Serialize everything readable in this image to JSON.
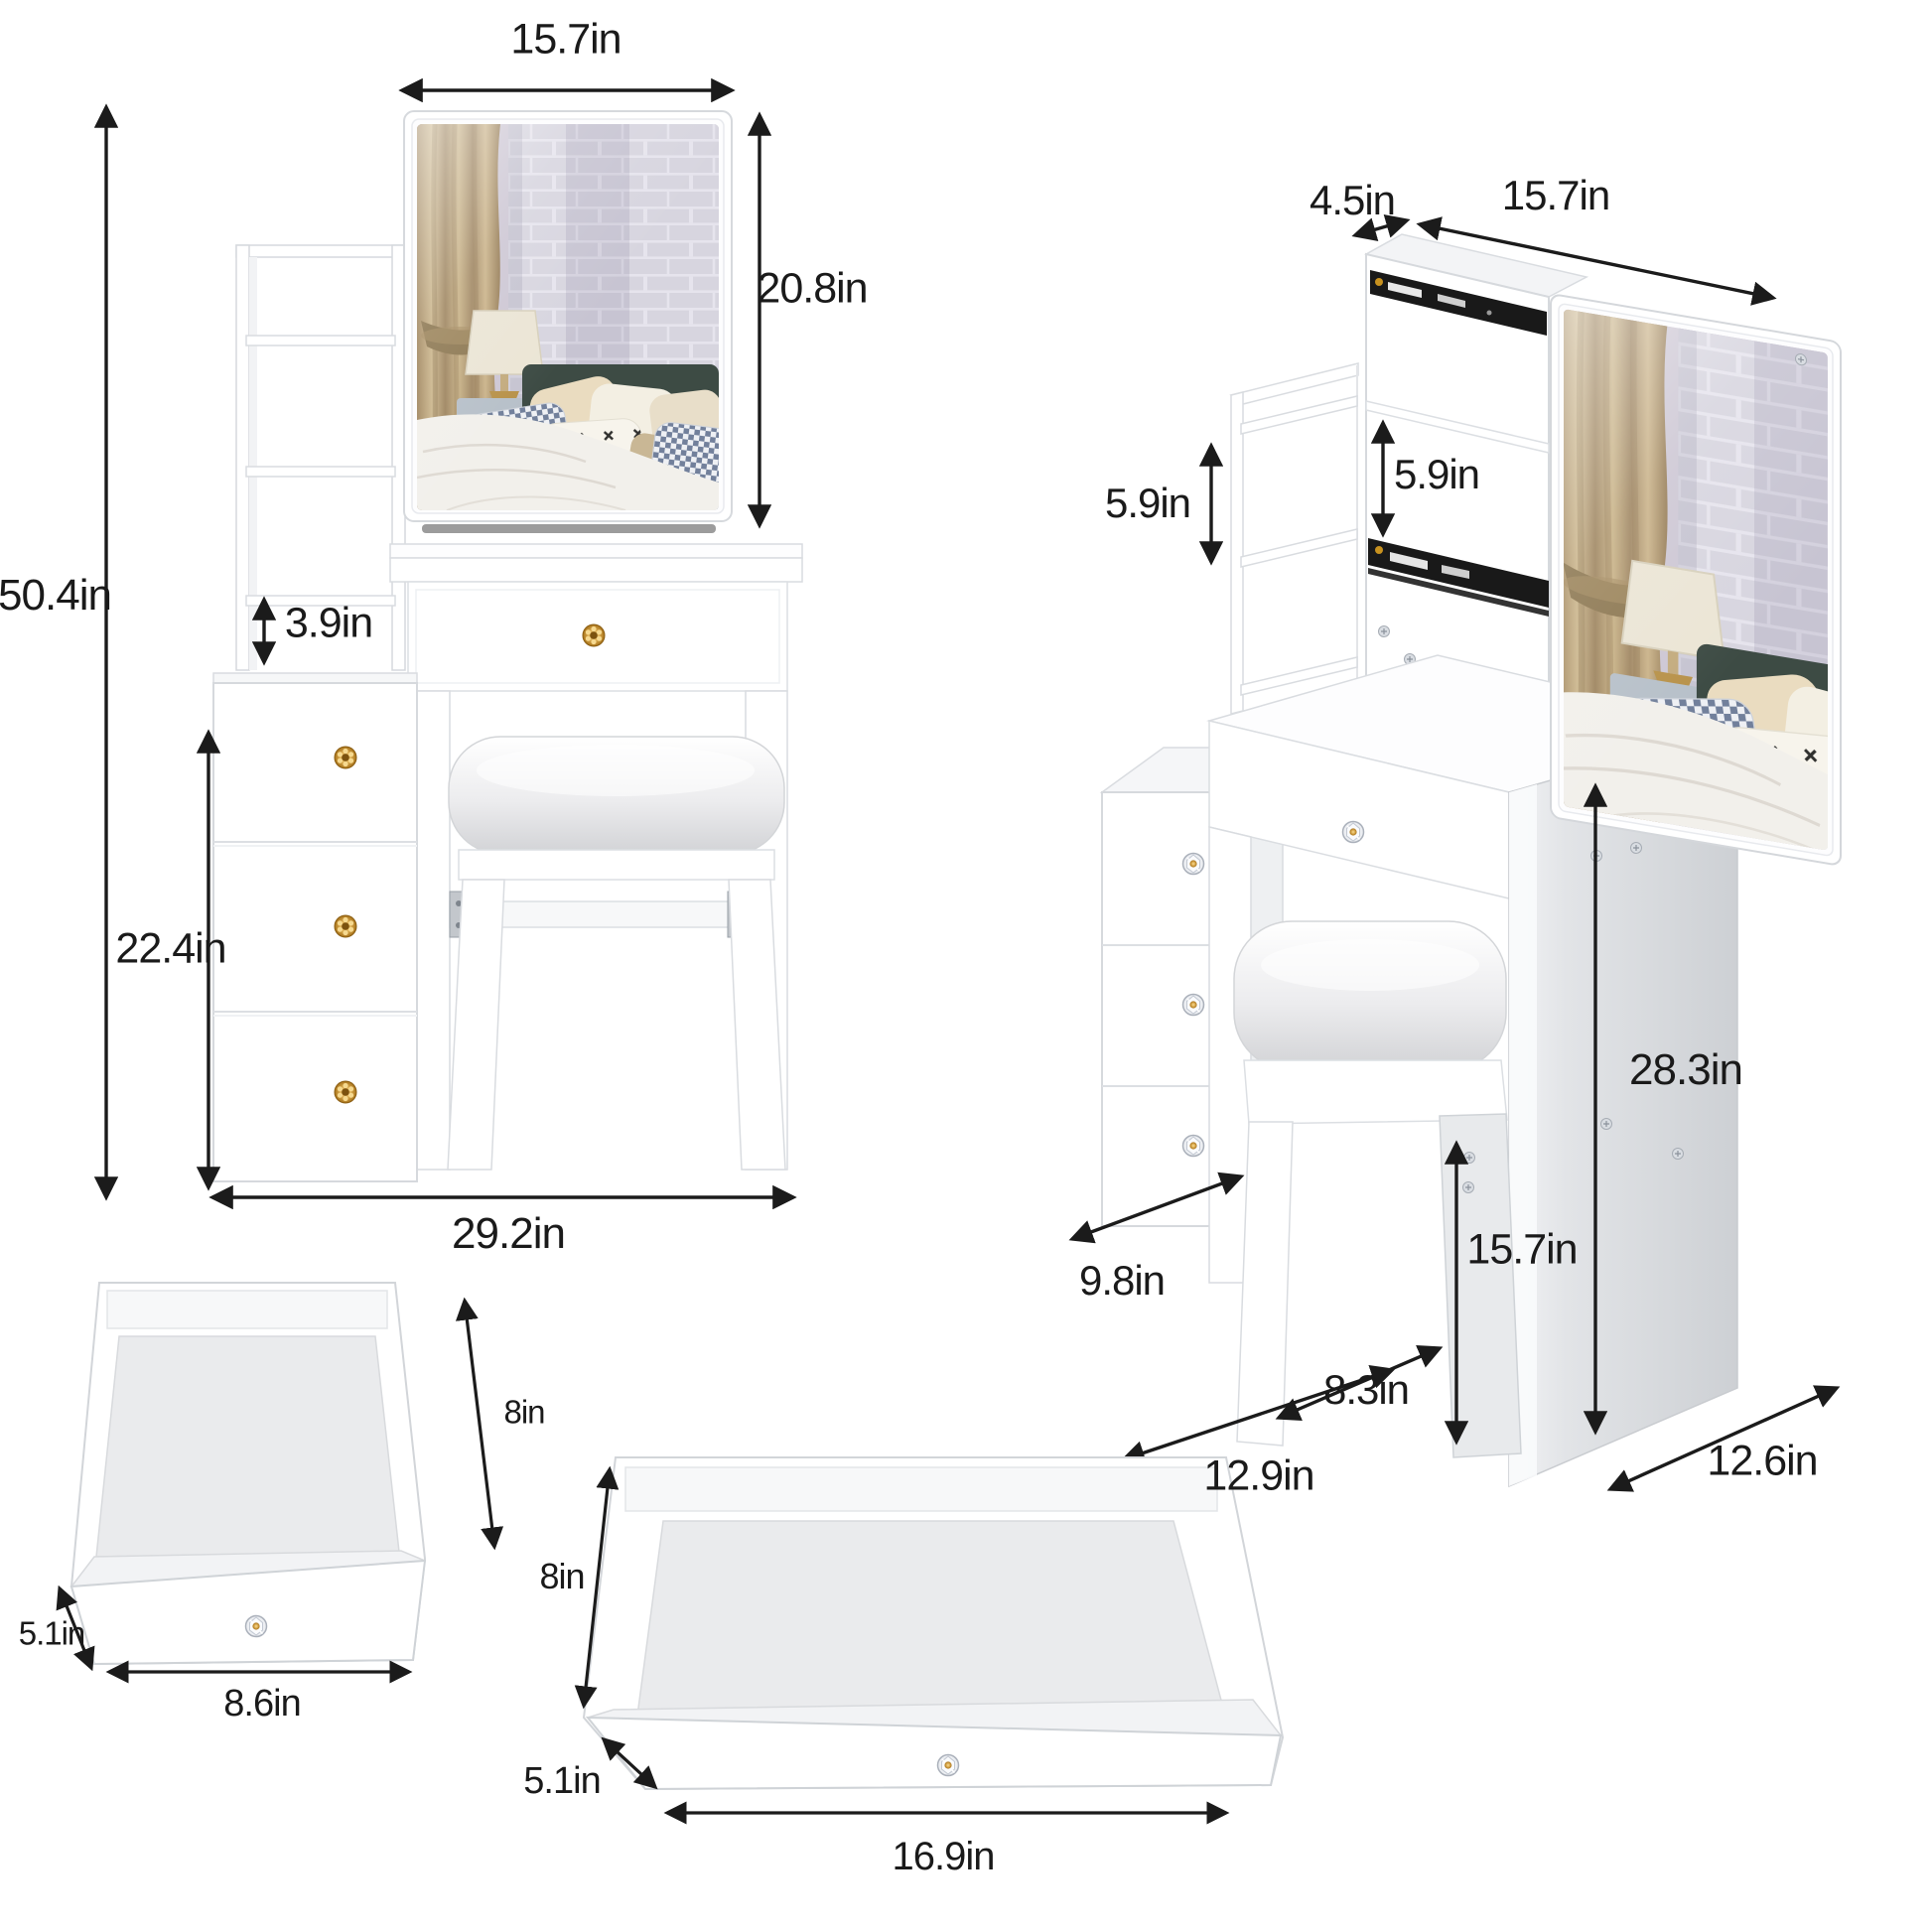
{
  "front_view": {
    "mirror_width": "15.7in",
    "mirror_height": "20.8in",
    "total_height": "50.4in",
    "shelf_gap": "3.9in",
    "cabinet_height": "22.4in",
    "total_width": "29.2in"
  },
  "side_view": {
    "top_depth": "4.5in",
    "mirror_width": "15.7in",
    "left_shelf_gap": "5.9in",
    "right_shelf_gap": "5.9in",
    "table_height": "28.3in",
    "stool_height": "15.7in",
    "cabinet_depth": "9.8in",
    "stool_depth": "8.3in",
    "stool_width": "12.9in",
    "table_depth": "12.6in"
  },
  "small_drawer": {
    "depth": "8in",
    "height": "5.1in",
    "width": "8.6in"
  },
  "large_drawer": {
    "depth": "8in",
    "height": "5.1in",
    "width": "16.9in"
  },
  "icons": {
    "dimension_arrow": "double-headed-arrow",
    "knob_gold": "gold-flower-knob",
    "knob_crystal": "crystal-knob",
    "screw": "screw-head",
    "drawer_rail": "ball-bearing-slide-rail"
  },
  "colors": {
    "background": "#ffffff",
    "dimension_line": "#1b1b1b",
    "panel_white": "#ffffff",
    "panel_edge": "#d6d9dd",
    "panel_shade": "#eef0f2",
    "side_panel_gray": "#cdd0d4",
    "rail_black": "#191919",
    "knob_gold": "#c8881f",
    "cushion_gray": "#e9eaec",
    "photo_wall": "#cdc7d4",
    "photo_brick": "#dcdbe3",
    "photo_curtain": "#b49b74",
    "photo_headboard": "#3d4b44",
    "photo_bed": "#f2f0eb"
  }
}
